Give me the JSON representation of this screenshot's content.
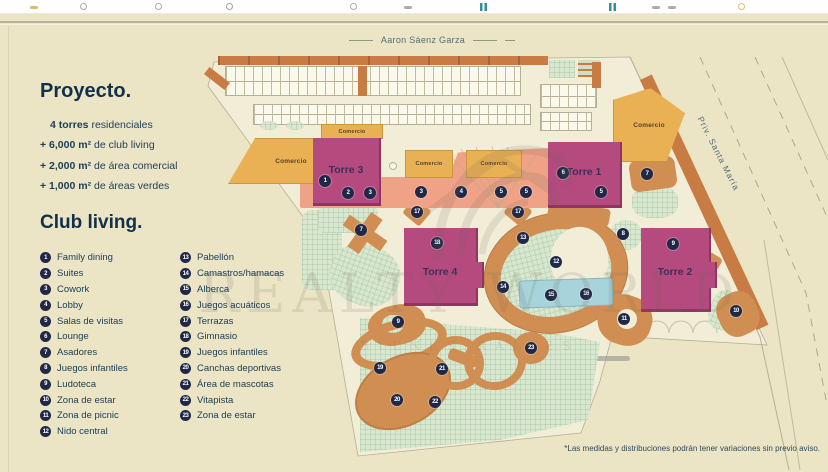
{
  "toolbar": {
    "icons": [
      {
        "x": 30,
        "shape": "bar",
        "color": "#d9b14a"
      },
      {
        "x": 80,
        "shape": "dot",
        "color": "#9aa09b"
      },
      {
        "x": 155,
        "shape": "dot",
        "color": "#9aa09b"
      },
      {
        "x": 226,
        "shape": "gear",
        "color": "#8f958f"
      },
      {
        "x": 350,
        "shape": "dot",
        "color": "#9aa09b"
      },
      {
        "x": 404,
        "shape": "bar",
        "color": "#9aa09b"
      },
      {
        "x": 480,
        "shape": "cols",
        "color": "#0f7d86"
      },
      {
        "x": 609,
        "shape": "cols",
        "color": "#0f7d86"
      },
      {
        "x": 652,
        "shape": "bar",
        "color": "#9aa09b"
      },
      {
        "x": 668,
        "shape": "bar",
        "color": "#9aa09b"
      },
      {
        "x": 738,
        "shape": "dot",
        "color": "#e2b54e"
      }
    ]
  },
  "panel": {
    "project_title": "Proyecto.",
    "project_lines": [
      {
        "bold": "4 torres",
        "rest": " residenciales",
        "indent": true
      },
      {
        "bold": "+ 6,000 m²",
        "rest": " de club living"
      },
      {
        "bold": "+ 2,000 m²",
        "rest": " de área comercial"
      },
      {
        "bold": "+ 1,000 m²",
        "rest": " de áreas verdes"
      }
    ],
    "legend_title": "Club living.",
    "legend_col1": [
      {
        "n": "1",
        "label": "Family dining"
      },
      {
        "n": "2",
        "label": "Suites"
      },
      {
        "n": "3",
        "label": "Cowork"
      },
      {
        "n": "4",
        "label": "Lobby"
      },
      {
        "n": "5",
        "label": "Salas de visitas"
      },
      {
        "n": "6",
        "label": "Lounge"
      },
      {
        "n": "7",
        "label": "Asadores"
      },
      {
        "n": "8",
        "label": "Juegos infantiles"
      },
      {
        "n": "9",
        "label": "Ludoteca"
      },
      {
        "n": "10",
        "label": "Zona de estar"
      },
      {
        "n": "11",
        "label": "Zona de picnic"
      },
      {
        "n": "12",
        "label": "Nido central"
      }
    ],
    "legend_col2": [
      {
        "n": "13",
        "label": "Pabellón"
      },
      {
        "n": "14",
        "label": "Camastros/hamacas"
      },
      {
        "n": "15",
        "label": "Alberca"
      },
      {
        "n": "16",
        "label": "Juegos acuáticos"
      },
      {
        "n": "17",
        "label": "Terrazas"
      },
      {
        "n": "18",
        "label": "Gimnasio"
      },
      {
        "n": "19",
        "label": "Juegos infantiles"
      },
      {
        "n": "20",
        "label": "Canchas deportivas"
      },
      {
        "n": "21",
        "label": "Área de mascotas"
      },
      {
        "n": "22",
        "label": "Vitapista"
      },
      {
        "n": "23",
        "label": "Zona de estar"
      }
    ]
  },
  "map": {
    "street_top": "Aaron Sáenz Garza",
    "street_right": "Priv. Santa María",
    "towers": [
      {
        "label": "Torre 3",
        "x": 313,
        "y": 138,
        "w": 68,
        "h": 68,
        "label_y": 26,
        "notch": false
      },
      {
        "label": "Torre 1",
        "x": 548,
        "y": 142,
        "w": 74,
        "h": 66,
        "label_y": 24,
        "notch": false
      },
      {
        "label": "Torre 4",
        "x": 404,
        "y": 228,
        "w": 74,
        "h": 78,
        "label_y": 38,
        "notch": true
      },
      {
        "label": "Torre 2",
        "x": 641,
        "y": 228,
        "w": 70,
        "h": 84,
        "label_y": 38,
        "notch": true
      }
    ],
    "commercial": [
      {
        "label": "Comercio",
        "x": 228,
        "y": 138,
        "w": 104,
        "h": 46,
        "fs": 6.5,
        "pl": 22,
        "clip": "polygon(26% 0, 100% 0, 100% 100%, 0 100%)"
      },
      {
        "label": "Comercio",
        "x": 321,
        "y": 124,
        "w": 62,
        "h": 15,
        "fs": 5.5
      },
      {
        "label": "Comercio",
        "x": 405,
        "y": 150,
        "w": 48,
        "h": 28,
        "fs": 5.5
      },
      {
        "label": "Comercio",
        "x": 466,
        "y": 150,
        "w": 56,
        "h": 28,
        "fs": 5.5
      },
      {
        "label": "Comercio",
        "x": 613,
        "y": 88,
        "w": 72,
        "h": 74,
        "fs": 6.5,
        "clip": "polygon(0 16%, 52% 0, 100% 34%, 74% 100%, 0 100%)"
      }
    ],
    "markers": [
      {
        "n": "1",
        "x": 325,
        "y": 181
      },
      {
        "n": "2",
        "x": 348,
        "y": 193
      },
      {
        "n": "3",
        "x": 370,
        "y": 193
      },
      {
        "n": "3",
        "x": 421,
        "y": 192
      },
      {
        "n": "4",
        "x": 461,
        "y": 192
      },
      {
        "n": "5",
        "x": 501,
        "y": 192
      },
      {
        "n": "5",
        "x": 526,
        "y": 192
      },
      {
        "n": "6",
        "x": 563,
        "y": 173
      },
      {
        "n": "5",
        "x": 601,
        "y": 192
      },
      {
        "n": "7",
        "x": 647,
        "y": 174
      },
      {
        "n": "17",
        "x": 417,
        "y": 212
      },
      {
        "n": "17",
        "x": 518,
        "y": 212
      },
      {
        "n": "7",
        "x": 361,
        "y": 230
      },
      {
        "n": "8",
        "x": 623,
        "y": 234
      },
      {
        "n": "13",
        "x": 523,
        "y": 238
      },
      {
        "n": "18",
        "x": 437,
        "y": 243
      },
      {
        "n": "9",
        "x": 673,
        "y": 244
      },
      {
        "n": "12",
        "x": 556,
        "y": 262
      },
      {
        "n": "14",
        "x": 503,
        "y": 287
      },
      {
        "n": "15",
        "x": 551,
        "y": 295
      },
      {
        "n": "16",
        "x": 586,
        "y": 294
      },
      {
        "n": "10",
        "x": 736,
        "y": 311
      },
      {
        "n": "11",
        "x": 624,
        "y": 319
      },
      {
        "n": "9",
        "x": 398,
        "y": 322
      },
      {
        "n": "23",
        "x": 531,
        "y": 348
      },
      {
        "n": "19",
        "x": 380,
        "y": 368
      },
      {
        "n": "21",
        "x": 442,
        "y": 369
      },
      {
        "n": "20",
        "x": 397,
        "y": 400
      },
      {
        "n": "22",
        "x": 435,
        "y": 402
      }
    ],
    "watermark": {
      "brand": "REALTY WORLD",
      "tagline": "BIENES RAÍCES"
    },
    "disclaimer": "*Las medidas y distribuciones podrán tener variaciones sin previo aviso."
  },
  "colors": {
    "beige": "#ebe4c5",
    "cream": "#f2edd7",
    "magenta": "#b44a7e",
    "yellow": "#eab054",
    "salmon": "#f0a287",
    "tan": "#d08e52",
    "green": "#d8e7cf",
    "pool": "#a7d4da",
    "curb": "#c87c44",
    "navy": "#1f2947"
  }
}
